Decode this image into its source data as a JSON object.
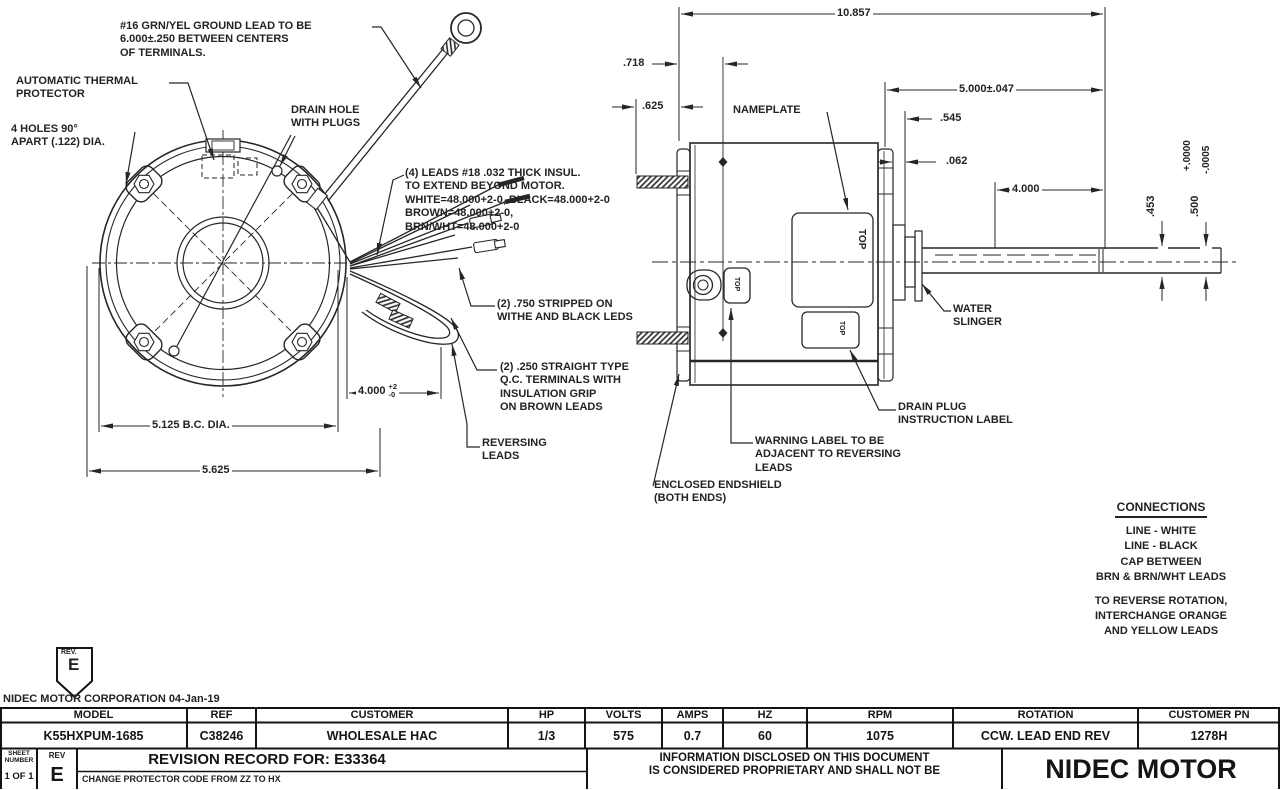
{
  "end_view": {
    "ground_lead": [
      "#16 GRN/YEL GROUND LEAD TO BE",
      "6.000±.250 BETWEEN CENTERS",
      "OF TERMINALS."
    ],
    "thermal_protector": [
      "AUTOMATIC THERMAL",
      "PROTECTOR"
    ],
    "mounting_holes": [
      "4 HOLES 90°",
      "APART (.122) DIA."
    ],
    "drain_hole": [
      "DRAIN HOLE",
      "WITH PLUGS"
    ],
    "leads_note": [
      "(4) LEADS #18 .032 THICK INSUL.",
      "TO EXTEND BEYOND MOTOR.",
      "WHITE=48.000+2-0, BLACK=48.000+2-0",
      "BROWN=48.000+2-0,",
      "BRN/WHT=48.000+2-0"
    ],
    "stripped_note": [
      "(2) .750 STRIPPED ON",
      "WITHE AND BLACK LEDS"
    ],
    "qc_note": [
      "(2) .250 STRAIGHT TYPE",
      "Q.C. TERMINALS WITH",
      "INSULATION GRIP",
      "ON BROWN LEADS"
    ],
    "reversing_note": [
      "REVERSING",
      "LEADS"
    ],
    "dim_bc": "5.125  B.C. DIA.",
    "dim_od": "5.625",
    "dim_leads": "4.000",
    "dim_leads_tol_plus": "+2",
    "dim_leads_tol_minus": "-0"
  },
  "side_view": {
    "nameplate": "NAMEPLATE",
    "water_slinger": [
      "WATER",
      "SLINGER"
    ],
    "drain_plug": [
      "DRAIN PLUG",
      "INSTRUCTION LABEL"
    ],
    "warning": [
      "WARNING LABEL TO BE",
      "ADJACENT TO REVERSING",
      "LEADS"
    ],
    "endshield": [
      "ENCLOSED ENDSHIELD",
      "(BOTH ENDS)"
    ],
    "top_label": "TOP",
    "dim_overall": "10.857",
    "dim_718": ".718",
    "dim_625": ".625",
    "dim_shaft_ext": "5.000±.047",
    "dim_545": ".545",
    "dim_062": ".062",
    "dim_4000": "4.000",
    "dim_453": ".453",
    "dim_500": ".500",
    "dim_tol_plus": "+.0000",
    "dim_tol_minus": "-.0005"
  },
  "connections": {
    "title": "CONNECTIONS",
    "lines": [
      "LINE - WHITE",
      "LINE - BLACK",
      "CAP BETWEEN",
      "BRN & BRN/WHT LEADS"
    ],
    "reverse_note": [
      "TO REVERSE ROTATION,",
      "INTERCHANGE ORANGE",
      "AND YELLOW LEADS"
    ]
  },
  "title_block": {
    "rev_flag_label": "REV.",
    "rev_flag_value": "E",
    "company_line": "NIDEC MOTOR CORPORATION 04-Jan-19",
    "headers": [
      "MODEL",
      "REF",
      "CUSTOMER",
      "HP",
      "VOLTS",
      "AMPS",
      "HZ",
      "RPM",
      "ROTATION",
      "CUSTOMER PN"
    ],
    "values": [
      "K55HXPUM-1685",
      "C38246",
      "WHOLESALE HAC",
      "1/3",
      "575",
      "0.7",
      "60",
      "1075",
      "CCW. LEAD END REV",
      "1278H"
    ],
    "sheet_label": [
      "SHEET",
      "NUMBER"
    ],
    "sheet_value": "1 OF 1",
    "rev_label": "REV",
    "rev_value": "E",
    "revision_title": "REVISION RECORD FOR:",
    "revision_number": "E33364",
    "revision_change": "CHANGE PROTECTOR CODE FROM ZZ TO HX",
    "proprietary": [
      "INFORMATION DISCLOSED ON THIS DOCUMENT",
      "IS CONSIDERED PROPRIETARY AND SHALL NOT BE"
    ],
    "company_name": "NIDEC MOTOR"
  },
  "colors": {
    "ink": "#262626",
    "paper": "#ffffff"
  }
}
